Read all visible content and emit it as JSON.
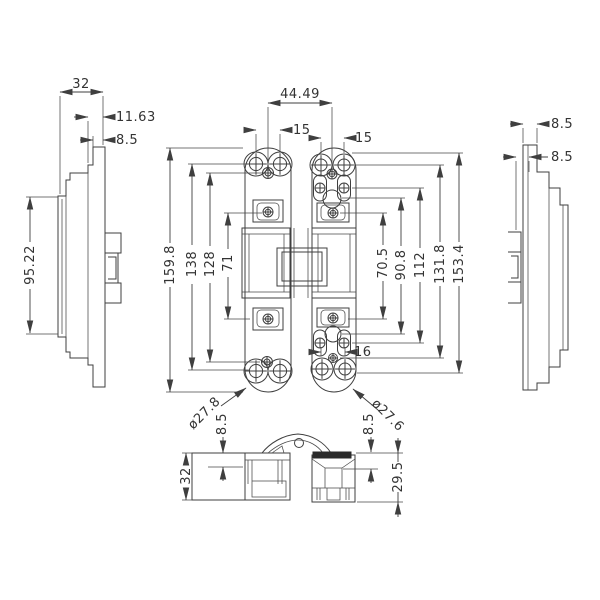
{
  "meta": {
    "background": "#ffffff",
    "line_color": "#3f3f3f",
    "text_color": "#333333",
    "drawing_type": "concealed hinge, 4-view engineering drawing"
  },
  "left_view": {
    "width": "32",
    "step1": "11.63",
    "step2": "8.5",
    "plate_height": "95.22"
  },
  "front_view": {
    "center_distance": "44.49",
    "left_hole_pitch": "15",
    "right_hole_pitch": "15",
    "overall_length": "159.8",
    "hole_span": "138",
    "screw_span": "128",
    "tab_span": "71",
    "right_dim_1": "70.5",
    "right_dim_2": "90.8",
    "right_dim_3": "112",
    "right_dim_4": "131.8",
    "right_dim_5": "153.4",
    "left_end_diameter": "ø27.8",
    "right_end_diameter": "ø27.6",
    "slot_pitch": "16"
  },
  "right_view": {
    "step1": "8.5",
    "step2": "8.5"
  },
  "bottom_view": {
    "left_depth": "32",
    "left_step": "8.5",
    "right_step": "8.5",
    "right_height": "29.5"
  }
}
